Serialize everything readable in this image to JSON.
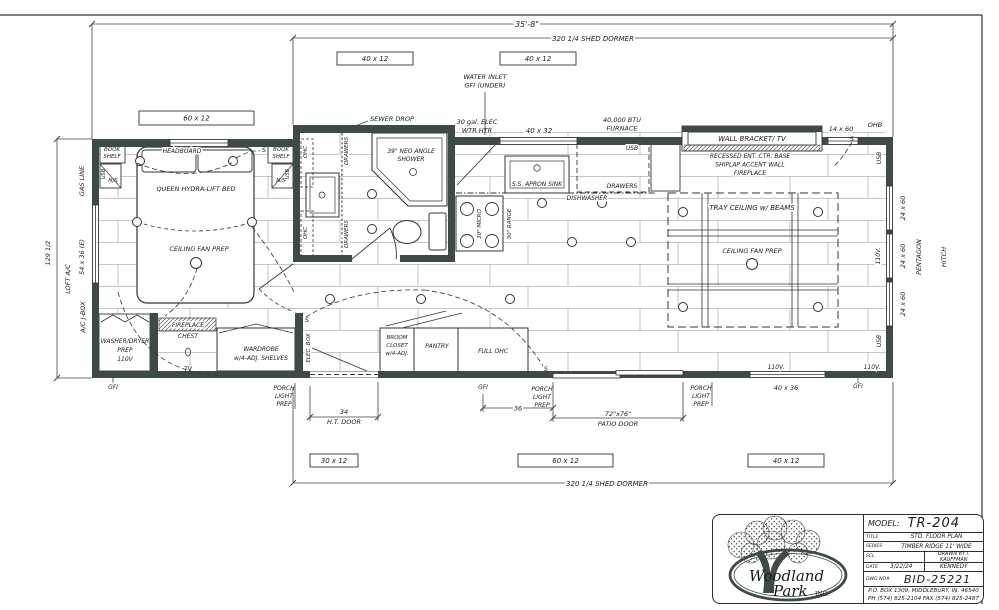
{
  "colors": {
    "wall": "#3e4b45",
    "line": "#333333",
    "plank": "#b4b4b4",
    "logo_green": "#3e4b45"
  },
  "window_boxes": [
    {
      "name": "window-box-60x12-top",
      "text": "60 x 12",
      "x": 139,
      "y": 111,
      "w": 115,
      "h": 14
    },
    {
      "name": "window-box-40x12-top-left",
      "text": "40 x 12",
      "x": 337,
      "y": 52,
      "w": 76,
      "h": 13
    },
    {
      "name": "window-box-40x12-top-right",
      "text": "40 x 12",
      "x": 500,
      "y": 52,
      "w": 76,
      "h": 13
    },
    {
      "name": "window-box-30x12-bottom",
      "text": "30 x 12",
      "x": 310,
      "y": 454,
      "w": 48,
      "h": 13
    },
    {
      "name": "window-box-60x12-bottom",
      "text": "60 x 12",
      "x": 518,
      "y": 454,
      "w": 95,
      "h": 13
    },
    {
      "name": "window-box-40x12-bottom",
      "text": "40 x 12",
      "x": 748,
      "y": 454,
      "w": 76,
      "h": 13
    }
  ],
  "labels": [
    {
      "n": "dim-overall-length",
      "t": "35'-8\"",
      "x": 527,
      "y": 27,
      "s": 8,
      "bg": true
    },
    {
      "n": "dim-shed-dormer-top",
      "t": "320 1/4 SHED DORMER",
      "x": 593,
      "y": 41,
      "s": 7,
      "bg": true
    },
    {
      "n": "water-inlet-line1",
      "t": "WATER INLET",
      "x": 485,
      "y": 79,
      "s": 6.5
    },
    {
      "n": "water-inlet-line2",
      "t": "GFI (UNDER)",
      "x": 485,
      "y": 87.5,
      "s": 6.5
    },
    {
      "n": "water-heater-line1",
      "t": "30 gal. ELEC",
      "x": 477,
      "y": 124,
      "s": 6.5
    },
    {
      "n": "water-heater-line2",
      "t": "WTR HTR",
      "x": 477,
      "y": 132.5,
      "s": 6.5
    },
    {
      "n": "window-40x32",
      "t": "40 x 32",
      "x": 539,
      "y": 133,
      "s": 7,
      "bg": true
    },
    {
      "n": "furnace-line1",
      "t": "40,000 BTU",
      "x": 622,
      "y": 122,
      "s": 6.5
    },
    {
      "n": "furnace-line2",
      "t": "FURNACE",
      "x": 622,
      "y": 130.5,
      "s": 6.5
    },
    {
      "n": "usb-furnace",
      "t": "USB",
      "x": 632,
      "y": 150,
      "s": 6,
      "bg": true
    },
    {
      "n": "wall-bracket-tv",
      "t": "WALL BRACKET/  TV",
      "x": 752,
      "y": 141,
      "s": 7
    },
    {
      "n": "window-14x60",
      "t": "14 x 60",
      "x": 841,
      "y": 131,
      "s": 6.5,
      "bg": true
    },
    {
      "n": "ohb",
      "t": "OHB",
      "x": 875,
      "y": 127,
      "s": 6.5
    },
    {
      "n": "recessed-line1",
      "t": "RECESSED ENT. CTR. BASE",
      "x": 750,
      "y": 158,
      "s": 6,
      "bg": true
    },
    {
      "n": "recessed-line2",
      "t": "SHIPLAP ACCENT WALL",
      "x": 750,
      "y": 166.5,
      "s": 6,
      "bg": true
    },
    {
      "n": "recessed-line3",
      "t": "FIREPLACE",
      "x": 750,
      "y": 175,
      "s": 6,
      "bg": true
    },
    {
      "n": "usb-right-top",
      "t": "USB",
      "x": 881,
      "y": 158,
      "s": 6,
      "r": -90,
      "bg": true
    },
    {
      "n": "window-24x60-1",
      "t": "24 x 60",
      "x": 905,
      "y": 208,
      "s": 6.5,
      "r": -90
    },
    {
      "n": "window-24x60-2",
      "t": "24 x 60",
      "x": 905,
      "y": 256,
      "s": 6.5,
      "r": -90
    },
    {
      "n": "window-24x60-3",
      "t": "24 x 60",
      "x": 905,
      "y": 304,
      "s": 6.5,
      "r": -90
    },
    {
      "n": "pentagon",
      "t": "PENTAGON",
      "x": 921,
      "y": 257,
      "s": 6.5,
      "r": -90
    },
    {
      "n": "hitch",
      "t": "HITCH",
      "x": 946,
      "y": 257,
      "s": 6.5,
      "r": -90
    },
    {
      "n": "outlet-110v-right",
      "t": "110V.",
      "x": 880,
      "y": 256,
      "s": 6,
      "r": -90,
      "bg": true
    },
    {
      "n": "usb-right-bottom",
      "t": "USB",
      "x": 881,
      "y": 341,
      "s": 6,
      "r": -90,
      "bg": true
    },
    {
      "n": "gfi-right",
      "t": "GFI",
      "x": 858,
      "y": 388,
      "s": 6
    },
    {
      "n": "outlet-110v-bottom1",
      "t": "110V.",
      "x": 776,
      "y": 369,
      "s": 6,
      "bg": true
    },
    {
      "n": "outlet-110v-bottom2",
      "t": "110V.",
      "x": 872,
      "y": 369,
      "s": 6,
      "bg": true
    },
    {
      "n": "window-40x36",
      "t": "40 x 36",
      "x": 786,
      "y": 390,
      "s": 6.5
    },
    {
      "n": "porch-light-right-1",
      "t": "PORCH",
      "x": 701,
      "y": 390,
      "s": 6
    },
    {
      "n": "porch-light-right-2",
      "t": "LIGHT",
      "x": 701,
      "y": 398,
      "s": 6
    },
    {
      "n": "porch-light-right-3",
      "t": "PREP",
      "x": 701,
      "y": 406,
      "s": 6
    },
    {
      "n": "patio-door-line1",
      "t": "72\"x76\"",
      "x": 618,
      "y": 416,
      "s": 6.5,
      "bg": true
    },
    {
      "n": "patio-door-line2",
      "t": "PATIO DOOR",
      "x": 618,
      "y": 426,
      "s": 6.5
    },
    {
      "n": "porch-light-mid-1",
      "t": "PORCH",
      "x": 542,
      "y": 391,
      "s": 6
    },
    {
      "n": "porch-light-mid-2",
      "t": "LIGHT",
      "x": 542,
      "y": 399,
      "s": 6
    },
    {
      "n": "porch-light-mid-3",
      "t": "PREP",
      "x": 542,
      "y": 407,
      "s": 6
    },
    {
      "n": "gfi-mid",
      "t": "GFI",
      "x": 483,
      "y": 389,
      "s": 6,
      "bg": true
    },
    {
      "n": "dim-36",
      "t": "36",
      "x": 518,
      "y": 410.5,
      "s": 6.5,
      "bg": true
    },
    {
      "n": "dim-ht-door-1",
      "t": "34",
      "x": 344,
      "y": 414,
      "s": 6.5,
      "bg": true
    },
    {
      "n": "dim-ht-door-2",
      "t": "H.T. DOOR",
      "x": 344,
      "y": 424,
      "s": 6.5
    },
    {
      "n": "porch-light-left-1",
      "t": "PORCH",
      "x": 284,
      "y": 390,
      "s": 6
    },
    {
      "n": "porch-light-left-2",
      "t": "LIGHT",
      "x": 284,
      "y": 398,
      "s": 6
    },
    {
      "n": "porch-light-left-3",
      "t": "PREP",
      "x": 284,
      "y": 406,
      "s": 6
    },
    {
      "n": "gfi-left",
      "t": "GFI",
      "x": 113,
      "y": 389,
      "s": 6
    },
    {
      "n": "dim-shed-dormer-bottom",
      "t": "320 1/4 SHED DORMER",
      "x": 607,
      "y": 486,
      "s": 7,
      "bg": true
    },
    {
      "n": "gas-line",
      "t": "GAS LINE",
      "x": 84,
      "y": 181,
      "s": 6.5,
      "r": -90
    },
    {
      "n": "dim-height-129",
      "t": "129 1/2",
      "x": 50,
      "y": 253,
      "s": 6.5,
      "r": -90,
      "bg": true
    },
    {
      "n": "window-54x36",
      "t": "54 x 36 (E)",
      "x": 84,
      "y": 257,
      "s": 6.5,
      "r": -90
    },
    {
      "n": "loft-ac",
      "t": "LOFT A/C",
      "x": 70,
      "y": 279,
      "s": 6.5,
      "r": -90
    },
    {
      "n": "ac-jbox",
      "t": "A/C J-BOX",
      "x": 85,
      "y": 317,
      "s": 6.5,
      "r": -90
    },
    {
      "n": "bookshelf-left-1",
      "t": "BOOK",
      "x": 112,
      "y": 151,
      "s": 5.5
    },
    {
      "n": "bookshelf-left-2",
      "t": "SHELF",
      "x": 112,
      "y": 158,
      "s": 5.5
    },
    {
      "n": "headboard",
      "t": "HEADBOARD",
      "x": 182,
      "y": 153,
      "s": 6,
      "bg": true
    },
    {
      "n": "bookshelf-right-1",
      "t": "BOOK",
      "x": 281,
      "y": 151,
      "s": 5.5
    },
    {
      "n": "bookshelf-right-2",
      "t": "SHELF",
      "x": 281,
      "y": 158,
      "s": 5.5
    },
    {
      "n": "usb-nightstand-left",
      "t": "USB",
      "x": 105,
      "y": 174,
      "s": 5,
      "r": -90
    },
    {
      "n": "nightstand-left",
      "t": "N/S",
      "x": 113,
      "y": 182,
      "s": 5.5
    },
    {
      "n": "usb-nightstand-right",
      "t": "USB",
      "x": 289,
      "y": 174,
      "s": 5,
      "r": -90
    },
    {
      "n": "nightstand-right",
      "t": "N/S",
      "x": 281,
      "y": 182,
      "s": 5.5
    },
    {
      "n": "queen-bed",
      "t": "QUEEN HYDRA-LIFT BED",
      "x": 196,
      "y": 191,
      "s": 6.5
    },
    {
      "n": "ceiling-fan-bedroom",
      "t": "CEILING FAN PREP",
      "x": 199,
      "y": 251,
      "s": 6.5
    },
    {
      "n": "sewer-drop",
      "t": "SEWER DROP",
      "x": 392,
      "y": 121,
      "s": 6.5,
      "bg": true
    },
    {
      "n": "shower-line1",
      "t": "39\" NEO ANGLE",
      "x": 411,
      "y": 153,
      "s": 6
    },
    {
      "n": "shower-line2",
      "t": "SHOWER",
      "x": 411,
      "y": 161,
      "s": 6
    },
    {
      "n": "ohc-bath-1",
      "t": "OHC",
      "x": 307,
      "y": 152,
      "s": 5.5,
      "r": -90,
      "bg": true
    },
    {
      "n": "ohc-bath-2",
      "t": "OHC",
      "x": 307,
      "y": 233,
      "s": 5.5,
      "r": -90,
      "bg": true
    },
    {
      "n": "drawers-bath-1",
      "t": "DRAWERS",
      "x": 348,
      "y": 151,
      "s": 5.5,
      "r": -90,
      "bg": true
    },
    {
      "n": "drawers-bath-2",
      "t": "DRAWERS",
      "x": 348,
      "y": 234,
      "s": 5.5,
      "r": -90,
      "bg": true
    },
    {
      "n": "apron-sink",
      "t": "S.S. APRON SINK",
      "x": 537,
      "y": 186,
      "s": 6
    },
    {
      "n": "drawers-kitchen",
      "t": "DRAWERS",
      "x": 622,
      "y": 188,
      "s": 6,
      "bg": true
    },
    {
      "n": "dishwasher",
      "t": "DISHWASHER",
      "x": 587,
      "y": 200,
      "s": 6,
      "bg": true
    },
    {
      "n": "micro",
      "t": "30\" MICRO",
      "x": 481,
      "y": 224,
      "s": 5.5,
      "r": -90,
      "bg": true
    },
    {
      "n": "range",
      "t": "30\" RANGE",
      "x": 511,
      "y": 224,
      "s": 5.5,
      "r": -90,
      "bg": true
    },
    {
      "n": "tray-ceiling",
      "t": "TRAY CEILING w/ BEAMS",
      "x": 752,
      "y": 210,
      "s": 7,
      "bg": true
    },
    {
      "n": "ceiling-fan-living",
      "t": "CEILING FAN PREP",
      "x": 752,
      "y": 253,
      "s": 6.5,
      "bg": true
    },
    {
      "n": "washer-dryer-1",
      "t": "WASHER/DRYER",
      "x": 125,
      "y": 343,
      "s": 6
    },
    {
      "n": "washer-dryer-2",
      "t": "PREP",
      "x": 125,
      "y": 352,
      "s": 6
    },
    {
      "n": "washer-dryer-3",
      "t": "110V",
      "x": 125,
      "y": 361,
      "s": 6
    },
    {
      "n": "fireplace",
      "t": "FIREPLACE",
      "x": 188,
      "y": 327,
      "s": 6,
      "bg": true
    },
    {
      "n": "chest",
      "t": "CHEST",
      "x": 188,
      "y": 338,
      "s": 6
    },
    {
      "n": "tv",
      "t": "TV",
      "x": 188,
      "y": 371,
      "s": 6
    },
    {
      "n": "wardrobe-1",
      "t": "WARDROBE",
      "x": 261,
      "y": 351,
      "s": 6
    },
    {
      "n": "wardrobe-2",
      "t": "w/4-ADJ. SHELVES",
      "x": 261,
      "y": 360,
      "s": 6
    },
    {
      "n": "elec-box",
      "t": "ELEC. BOX",
      "x": 310,
      "y": 348,
      "s": 5.5,
      "r": -90,
      "bg": true
    },
    {
      "n": "broom-1",
      "t": "BROOM",
      "x": 397,
      "y": 339,
      "s": 5.5
    },
    {
      "n": "broom-2",
      "t": "CLOSET",
      "x": 397,
      "y": 347,
      "s": 5.5
    },
    {
      "n": "broom-3",
      "t": "w/4-ADJ.",
      "x": 397,
      "y": 355,
      "s": 5.5
    },
    {
      "n": "pantry",
      "t": "PANTRY",
      "x": 437,
      "y": 348,
      "s": 6
    },
    {
      "n": "full-ohc",
      "t": "FULL OHC",
      "x": 493,
      "y": 353,
      "s": 6
    },
    {
      "n": "switch-1",
      "t": "S",
      "x": 264,
      "y": 152,
      "s": 6.5
    },
    {
      "n": "switch-2",
      "t": "S",
      "x": 307,
      "y": 322,
      "s": 6.5
    },
    {
      "n": "switch-3",
      "t": "S",
      "x": 546,
      "y": 371,
      "s": 6.5
    },
    {
      "n": "switch-4",
      "t": "S",
      "x": 852,
      "y": 141,
      "s": 6.5
    }
  ],
  "title_block": {
    "model_label": "MODEL:",
    "model_value": "TR-204",
    "title_label": "TITLE",
    "title_value": "STD. FLOOR PLAN",
    "series_label": "SERIES",
    "series_value": "TIMBER RIDGE 11' WIDE",
    "scale_label": "SCL",
    "drawn_by": "DRAWN BY  I. KAUFFMAN",
    "date_label": "DATE",
    "date_value": "3/22/24",
    "checked_by": "KENNEDY",
    "dwg_label": "DWG NO#",
    "dwg_value": "BID-25221",
    "address": "P.O. BOX 1309, MIDDLEBURY, IN. 46540",
    "phone": "PH (574) 825-2104  FAX (574) 825-2487",
    "company_line1": "Woodland",
    "company_line2": "Park",
    "company_suffix": "INC."
  }
}
